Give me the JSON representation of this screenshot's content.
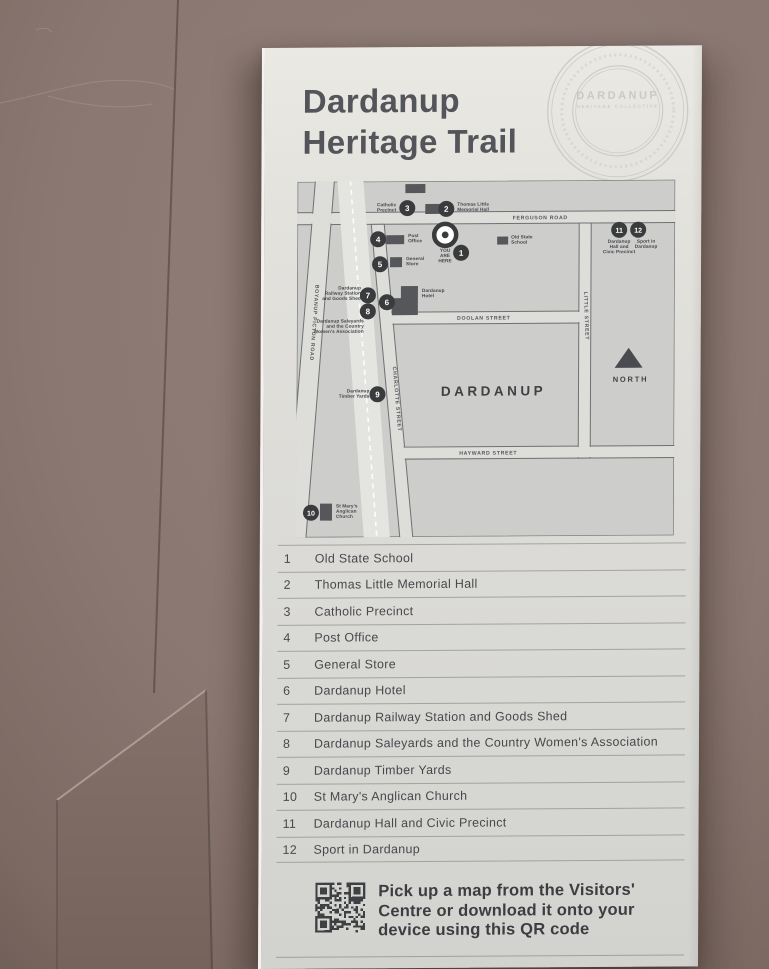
{
  "sign": {
    "title_lines": [
      "Dardanup",
      "Heritage Trail"
    ],
    "stamp": {
      "name": "DARDANUP",
      "subtitle": "HERITAGE COLLECTIVE"
    },
    "qr_note_lines": [
      "Pick up a map from the Visitors'",
      "Centre or download it onto your",
      "device using this QR code"
    ]
  },
  "map_data": {
    "type": "street-map",
    "town_label": "DARDANUP",
    "north_label": "NORTH",
    "you_are_here": {
      "lines": [
        "YOU",
        "ARE",
        "HERE"
      ],
      "x": 148,
      "y": 71
    },
    "street_labels": [
      {
        "text": "FERGUSON ROAD",
        "x": 243,
        "y": 39,
        "rotate": 0
      },
      {
        "text": "DOOLAN STREET",
        "x": 187,
        "y": 139,
        "rotate": 0
      },
      {
        "text": "HAYWARD STREET",
        "x": 192,
        "y": 274,
        "rotate": 0
      },
      {
        "text": "CHARLOTTE STREET",
        "x": 99,
        "y": 218,
        "rotate": 85
      },
      {
        "text": "LITTLE STREET",
        "x": 288,
        "y": 136,
        "rotate": 88
      },
      {
        "text": "BOYANUP PICTON ROAD",
        "x": 16,
        "y": 141,
        "rotate": 94
      }
    ],
    "markers": [
      {
        "n": "1",
        "x": 164,
        "y": 72
      },
      {
        "n": "2",
        "x": 149,
        "y": 28
      },
      {
        "n": "3",
        "x": 110,
        "y": 27
      },
      {
        "n": "4",
        "x": 81,
        "y": 58
      },
      {
        "n": "5",
        "x": 83,
        "y": 83
      },
      {
        "n": "6",
        "x": 90,
        "y": 121
      },
      {
        "n": "7",
        "x": 71,
        "y": 114
      },
      {
        "n": "8",
        "x": 71,
        "y": 130
      },
      {
        "n": "9",
        "x": 81,
        "y": 213
      },
      {
        "n": "10",
        "x": 15,
        "y": 331
      },
      {
        "n": "11",
        "x": 322,
        "y": 50
      },
      {
        "n": "12",
        "x": 341,
        "y": 50
      }
    ],
    "site_labels": [
      {
        "lines": [
          "Catholic",
          "Precinct"
        ],
        "x": 99,
        "y": 25,
        "anchor": "end"
      },
      {
        "lines": [
          "Thomas Little",
          "Memorial Hall"
        ],
        "x": 160,
        "y": 25,
        "anchor": "start"
      },
      {
        "lines": [
          "Post",
          "Office"
        ],
        "x": 111,
        "y": 56,
        "anchor": "start"
      },
      {
        "lines": [
          "Old State",
          "School"
        ],
        "x": 214,
        "y": 58,
        "anchor": "start"
      },
      {
        "lines": [
          "General",
          "Store"
        ],
        "x": 109,
        "y": 79,
        "anchor": "start"
      },
      {
        "lines": [
          "Dardanup",
          "Railway Station",
          "and Goods Shed"
        ],
        "x": 64,
        "y": 108,
        "anchor": "end"
      },
      {
        "lines": [
          "Dardanup",
          "Hotel"
        ],
        "x": 125,
        "y": 111,
        "anchor": "start"
      },
      {
        "lines": [
          "Dardanup Saleyards",
          "and the Country",
          "Women's Association"
        ],
        "x": 67,
        "y": 141,
        "anchor": "end"
      },
      {
        "lines": [
          "Dardanup",
          "Timber Yards"
        ],
        "x": 73,
        "y": 211,
        "anchor": "end"
      },
      {
        "lines": [
          "St Mary's",
          "Anglican",
          "Church"
        ],
        "x": 40,
        "y": 326,
        "anchor": "start"
      },
      {
        "lines": [
          "Dardanup",
          "Hall and",
          "Civic Precinct"
        ],
        "x": 322,
        "y": 63,
        "anchor": "middle"
      },
      {
        "lines": [
          "Sport in",
          "Dardanup"
        ],
        "x": 349,
        "y": 63,
        "anchor": "middle"
      }
    ]
  },
  "legend": {
    "items": [
      {
        "num": "1",
        "name": "Old State School"
      },
      {
        "num": "2",
        "name": "Thomas Little Memorial Hall"
      },
      {
        "num": "3",
        "name": "Catholic Precinct"
      },
      {
        "num": "4",
        "name": "Post Office"
      },
      {
        "num": "5",
        "name": "General Store"
      },
      {
        "num": "6",
        "name": "Dardanup Hotel"
      },
      {
        "num": "7",
        "name": "Dardanup Railway Station and Goods Shed"
      },
      {
        "num": "8",
        "name": "Dardanup Saleyards and the Country Women's Association"
      },
      {
        "num": "9",
        "name": "Dardanup Timber Yards"
      },
      {
        "num": "10",
        "name": "St Mary's Anglican Church"
      },
      {
        "num": "11",
        "name": "Dardanup Hall and Civic Precinct"
      },
      {
        "num": "12",
        "name": "Sport in Dardanup"
      }
    ]
  },
  "colors": {
    "wall": "#8d7a74",
    "sign_bg": "#e3e2dd",
    "map_bg": "#cdcecb",
    "road_fill": "#dddeda",
    "road_stroke": "#6f7072",
    "rail_fill": "#e4e5e1",
    "building": "#56575b",
    "marker": "#3a3b3d",
    "title_text": "#54555a",
    "legend_text": "#47484c"
  }
}
